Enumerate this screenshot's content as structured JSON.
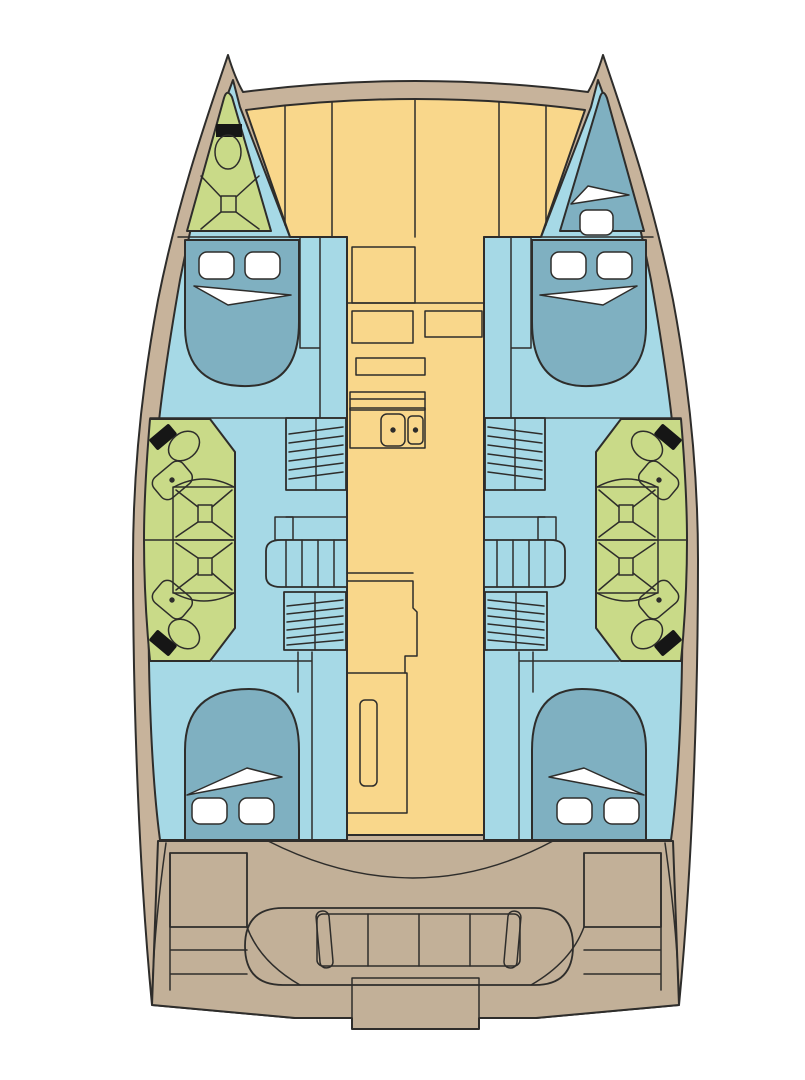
{
  "diagram": {
    "type": "boat-floor-plan",
    "subject": "catamaran interior deck plan, top view",
    "double_cabins": 4,
    "forepeak_berths": 1,
    "bathrooms": 5,
    "showers": 5,
    "bathroom_sinks": 4,
    "galley_sinks": 2,
    "companionway_stairs": 2,
    "cockpit_sofa_seats": 4,
    "cockpit_tables": 2
  },
  "colors": {
    "background": "#ffffff",
    "outline": "#2e2d2b",
    "deck": "#c7b39b",
    "cockpit": "#c2b098",
    "saloon": "#f9d78b",
    "hull_interior": "#a6d9e6",
    "bed": "#7fb0c1",
    "bathroom": "#c9da88",
    "fixture_black": "#161616",
    "linen": "#ffffff"
  },
  "regions": {
    "port_bow": "bow head with toilet and shower",
    "starboard_bow": "forepeak berth",
    "port_forward": "double cabin",
    "port_midship": "two bathroom units with wardrobes",
    "port_aft": "double cabin",
    "starboard_forward": "double cabin",
    "starboard_midship": "two bathroom units with wardrobes",
    "starboard_aft": "double cabin",
    "center_forward": "saloon seating",
    "center_mid": "nav station and galley with double sink",
    "center_aft": "galley counter and passage",
    "stern": "cockpit with sofa, tables and transom platform"
  }
}
